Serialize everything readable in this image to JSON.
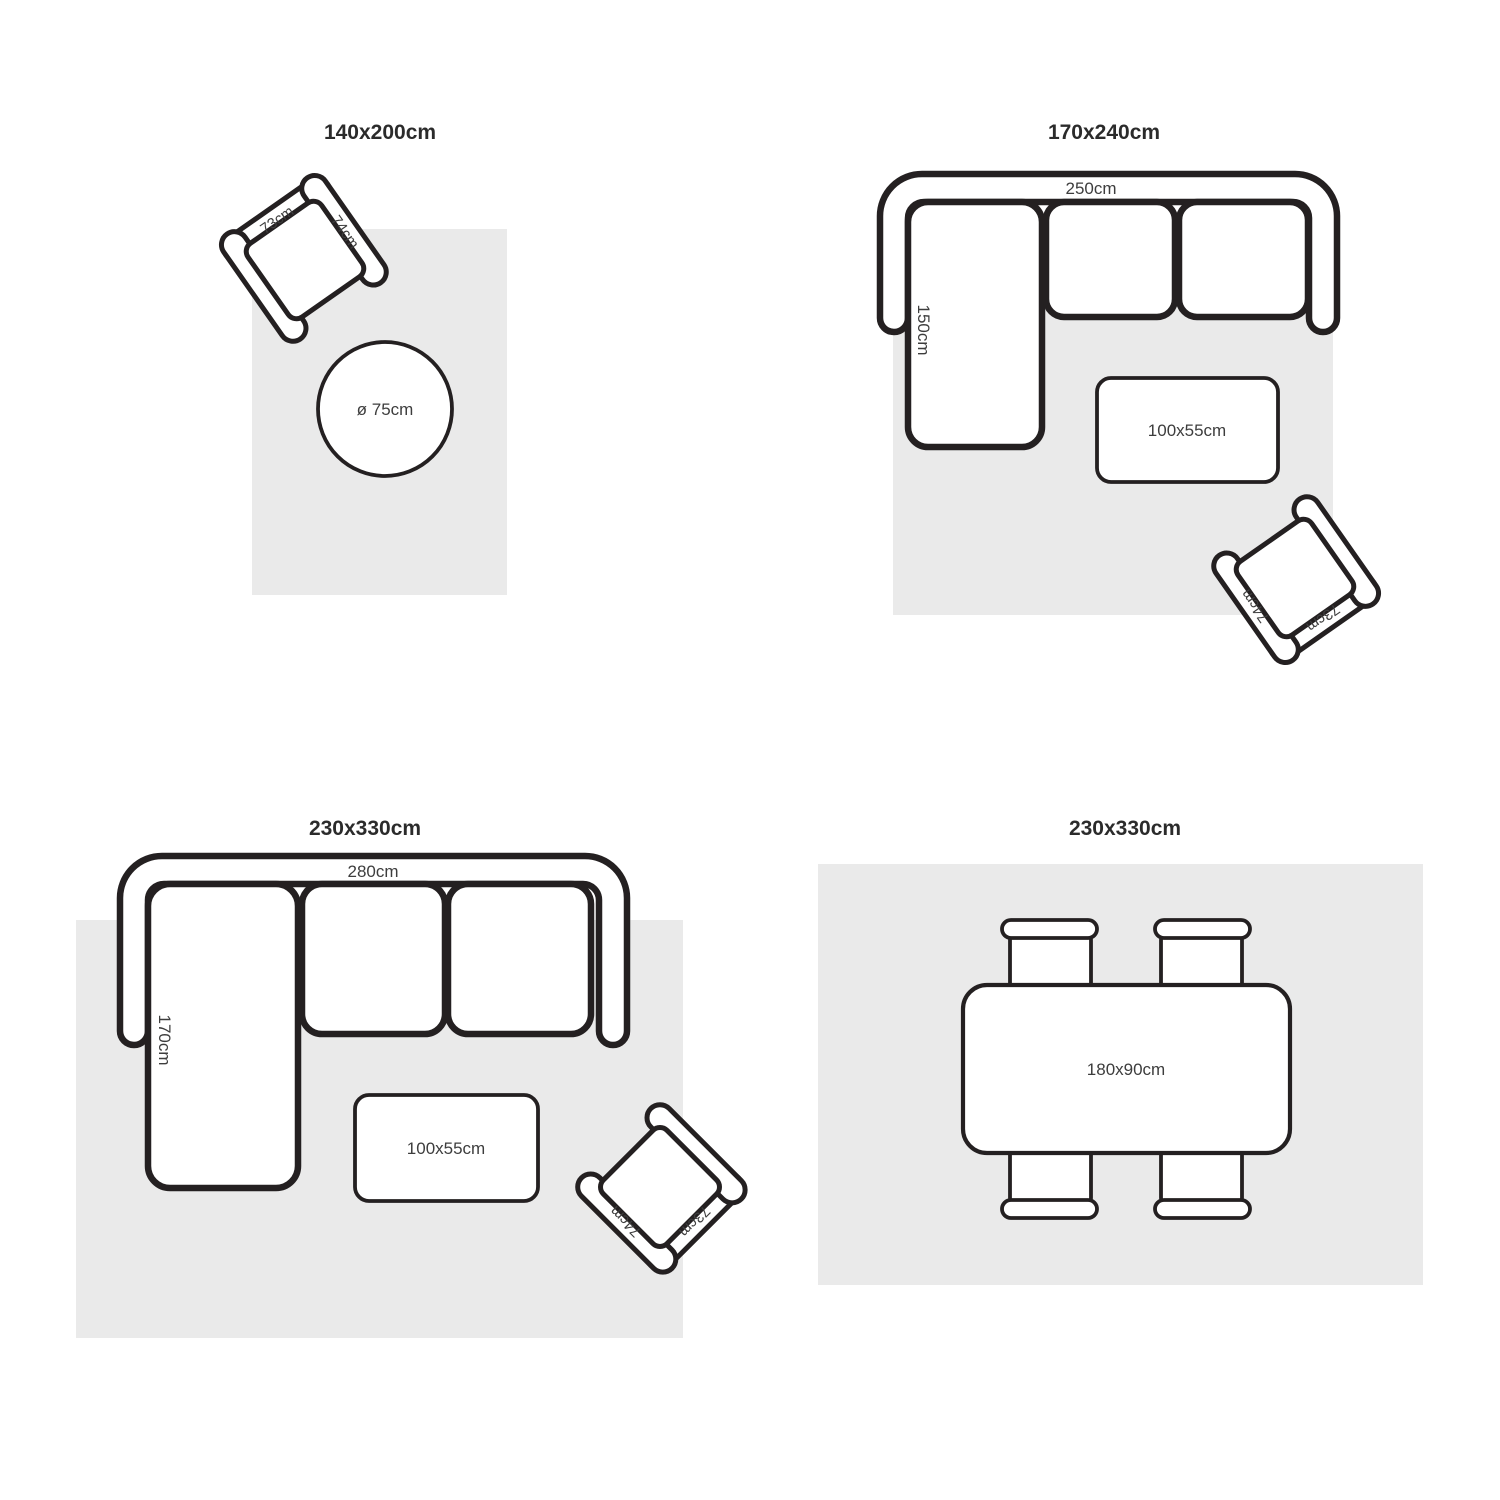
{
  "colors": {
    "background": "#ffffff",
    "rug": "#eaeaea",
    "outline": "#242021",
    "label_text": "#3d3d3d",
    "title_text": "#2b2b2b"
  },
  "quadrants": [
    {
      "title": "140x200cm",
      "armchair": {
        "back_width": "73cm",
        "side_depth": "74cm"
      },
      "round_table": {
        "diameter": "ø 75cm"
      }
    },
    {
      "title": "170x240cm",
      "sofa": {
        "total_width": "250cm",
        "chaise_depth": "150cm"
      },
      "coffee_table": {
        "size": "100x55cm"
      },
      "armchair": {
        "back_width": "73cm",
        "side_depth": "74cm"
      }
    },
    {
      "title": "230x330cm",
      "sofa": {
        "total_width": "280cm",
        "chaise_depth": "170cm"
      },
      "coffee_table": {
        "size": "100x55cm"
      },
      "armchair": {
        "back_width": "73cm",
        "side_depth": "74cm"
      }
    },
    {
      "title": "230x330cm",
      "dining_table": {
        "size": "180x90cm"
      }
    }
  ]
}
